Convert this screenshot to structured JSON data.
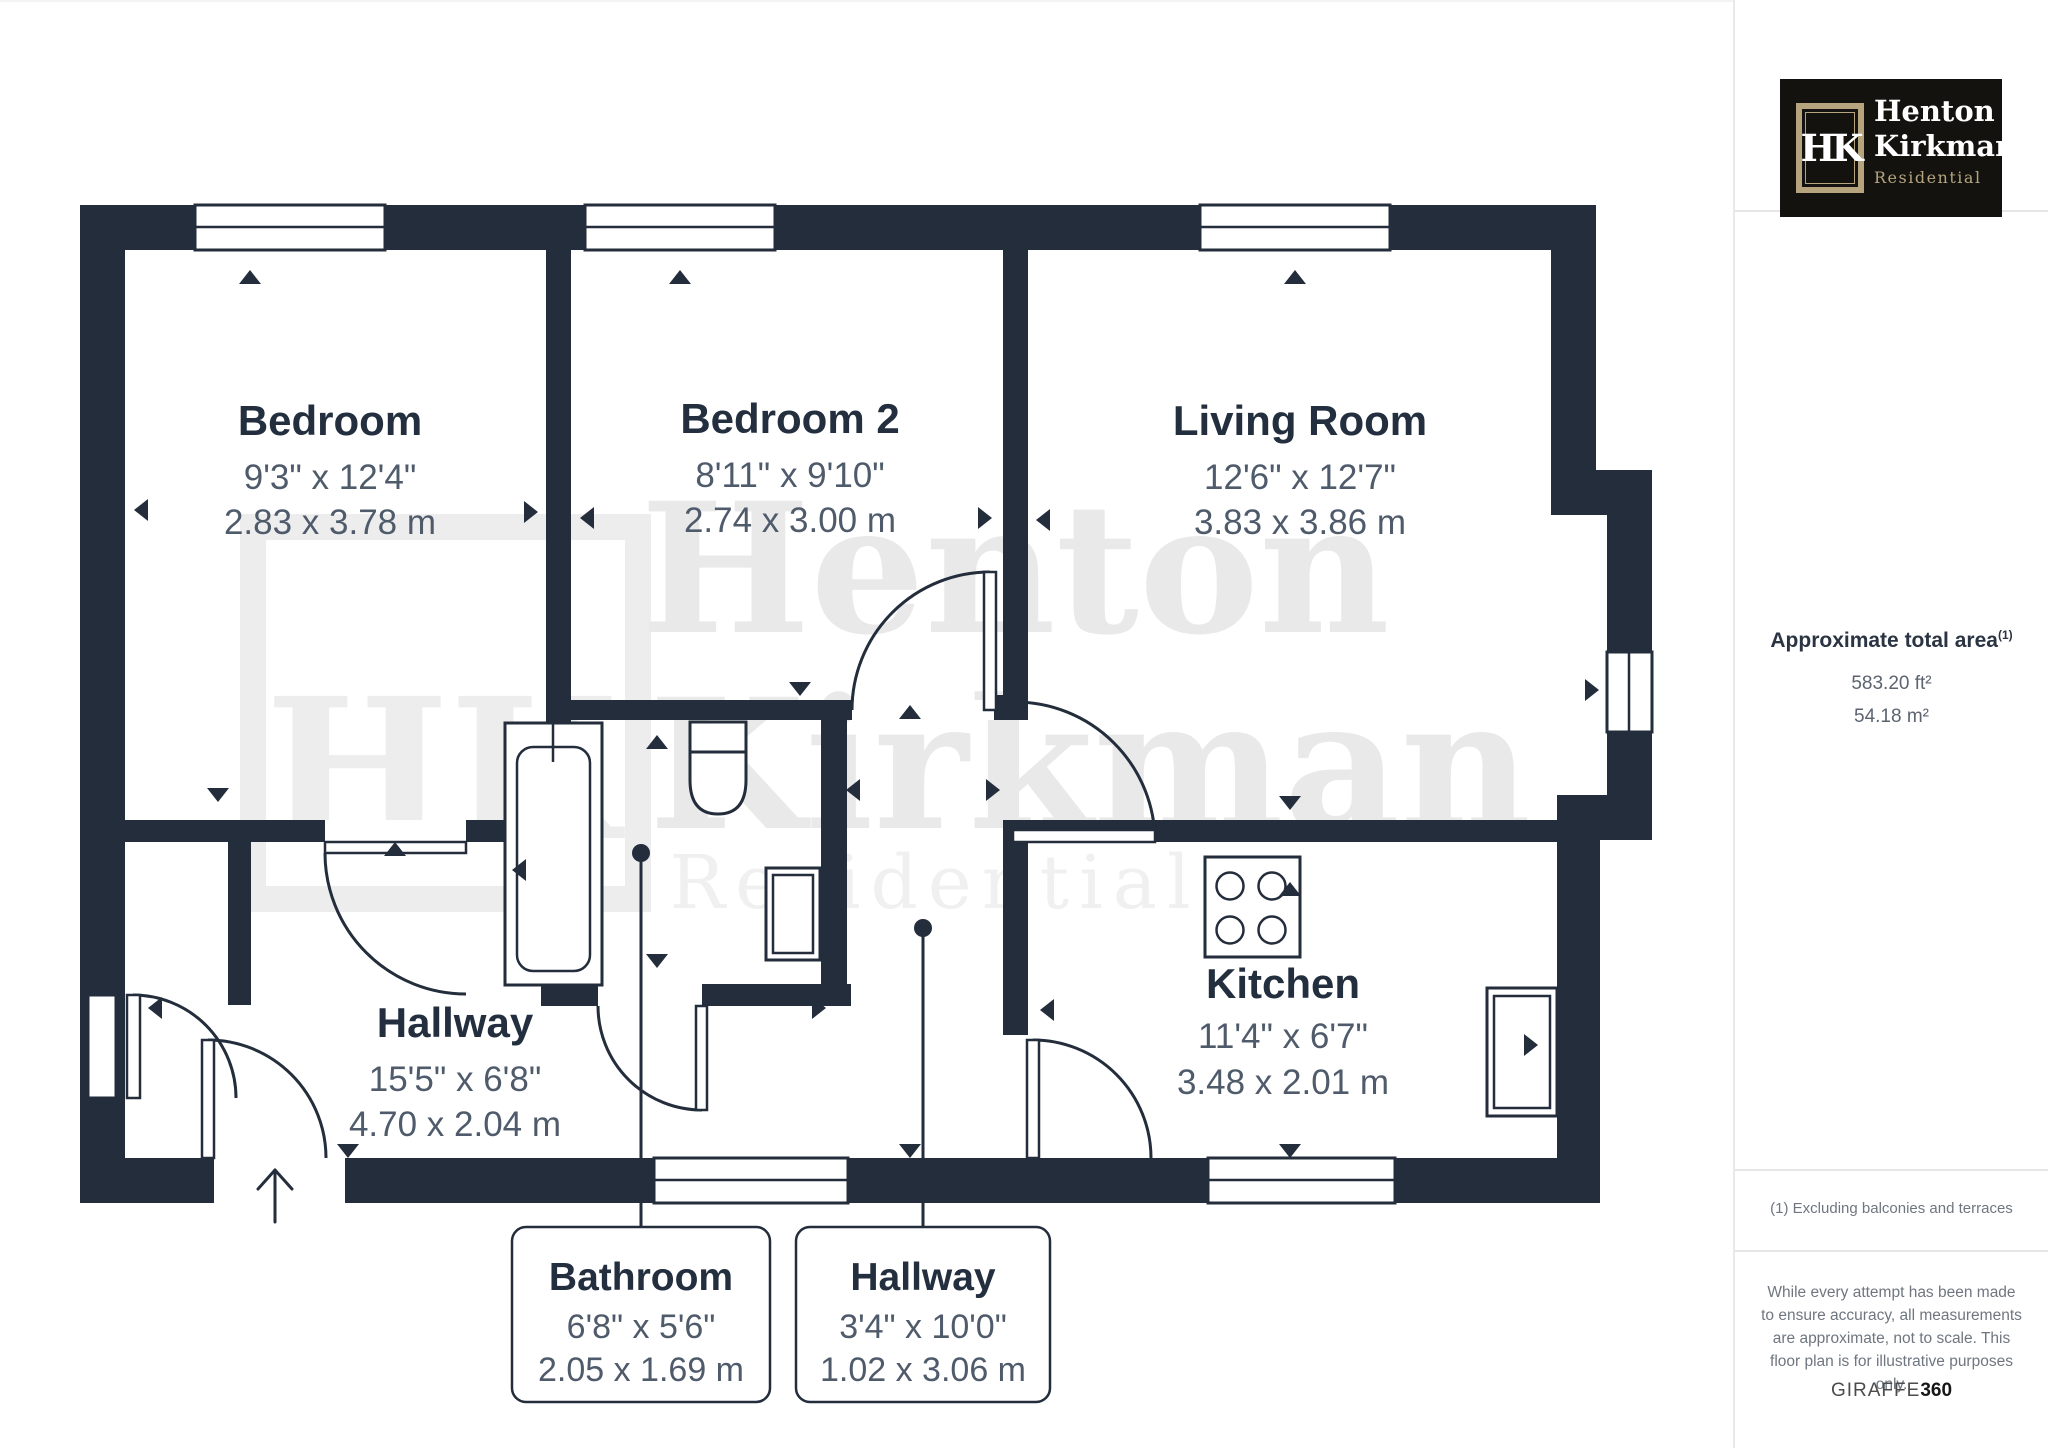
{
  "plan": {
    "rooms": [
      {
        "name": "Bedroom",
        "dims_ft": "9'3\" x 12'4\"",
        "dims_m": "2.83 x 3.78 m"
      },
      {
        "name": "Bedroom 2",
        "dims_ft": "8'11\" x 9'10\"",
        "dims_m": "2.74 x 3.00 m"
      },
      {
        "name": "Living Room",
        "dims_ft": "12'6\" x 12'7\"",
        "dims_m": "3.83 x 3.86 m"
      },
      {
        "name": "Hallway",
        "dims_ft": "15'5\" x 6'8\"",
        "dims_m": "4.70 x 2.04 m"
      },
      {
        "name": "Kitchen",
        "dims_ft": "11'4\" x 6'7\"",
        "dims_m": "3.48 x 2.01 m"
      }
    ],
    "callouts": [
      {
        "name": "Bathroom",
        "dims_ft": "6'8\" x 5'6\"",
        "dims_m": "2.05 x 1.69 m"
      },
      {
        "name": "Hallway",
        "dims_ft": "3'4\" x 10'0\"",
        "dims_m": "1.02 x 3.06 m"
      }
    ],
    "watermark": {
      "line1": "Henton",
      "line2": "Kirkman",
      "line3": "Residential",
      "monogram": "HK"
    }
  },
  "sidebar": {
    "logo": {
      "monogram": "HK",
      "name_line1": "Henton",
      "name_line2": "Kirkman",
      "tagline": "Residential"
    },
    "area": {
      "heading": "Approximate total area",
      "superscript": "(1)",
      "ft": "583.20 ft²",
      "m": "54.18 m²"
    },
    "footnote": "(1) Excluding balconies and terraces",
    "disclaimer": "While every attempt has been made to ensure accuracy, all measurements are approximate, not to scale. This floor plan is for illustrative purposes only.",
    "brand": {
      "giraffe": "GIRAFFE",
      "num": "360"
    }
  },
  "colors": {
    "wall": "#232d3b",
    "room_title": "#232f3e",
    "dimensions": "#4f5b6b",
    "watermark": "#e9e9e9",
    "logo_gold": "#b5a47e",
    "logo_background": "#14120e"
  }
}
